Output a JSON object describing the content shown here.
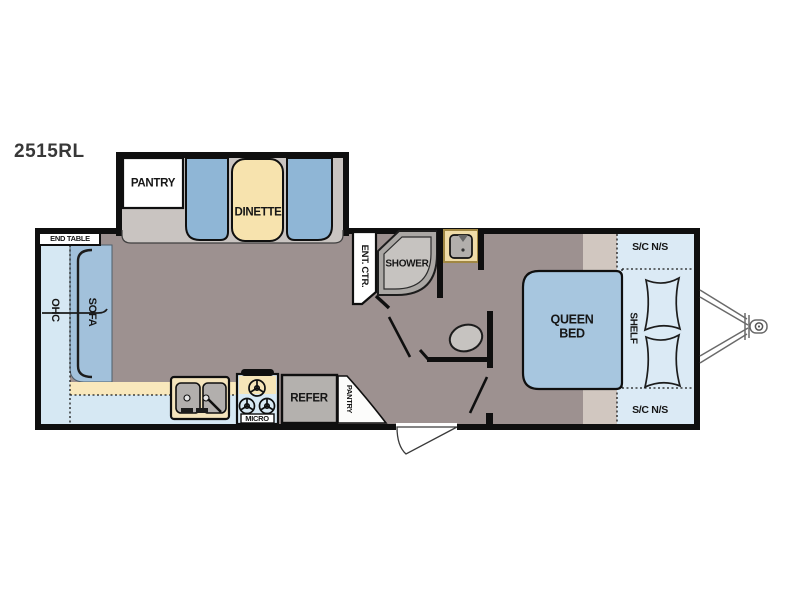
{
  "title": "2515RL",
  "slideout": {
    "pantry_label": "PANTRY",
    "dinette_label": "DINETTE"
  },
  "living_area": {
    "end_table_label": "END TABLE",
    "ohc_label": "OHC",
    "sofa_label": "SOFA"
  },
  "kitchen": {
    "micro_label": "MICRO",
    "refrigerator_label": "REFER",
    "pantry_label": "PANTRY"
  },
  "bathroom": {
    "entertainment_center_label": "ENT. CTR.",
    "shower_label": "SHOWER"
  },
  "bedroom": {
    "bed_label": "QUEEN BED",
    "shelf_label": "SHELF",
    "storage_front_top_label": "S/C N/S",
    "storage_front_bottom_label": "S/C N/S"
  },
  "colors": {
    "wall": "#0f0f0f",
    "floor_main": "#9d9190",
    "floor_slideout": "#c9c4c1",
    "seat_blue": "#8fb6d6",
    "sofa_blue": "#a2c1db",
    "bed_blue": "#a7c6df",
    "table_cream": "#f7e3ae",
    "counter_cream": "#f9e8bc",
    "vanity_cream": "#efdca8",
    "cabinet_light_blue": "#d6e8f3",
    "storage_light_blue": "#dbeaf5",
    "appliance_gray": "#b4b1ae",
    "platform_beige": "#d1c7c0",
    "shower_gray": "#aaa7a4"
  }
}
